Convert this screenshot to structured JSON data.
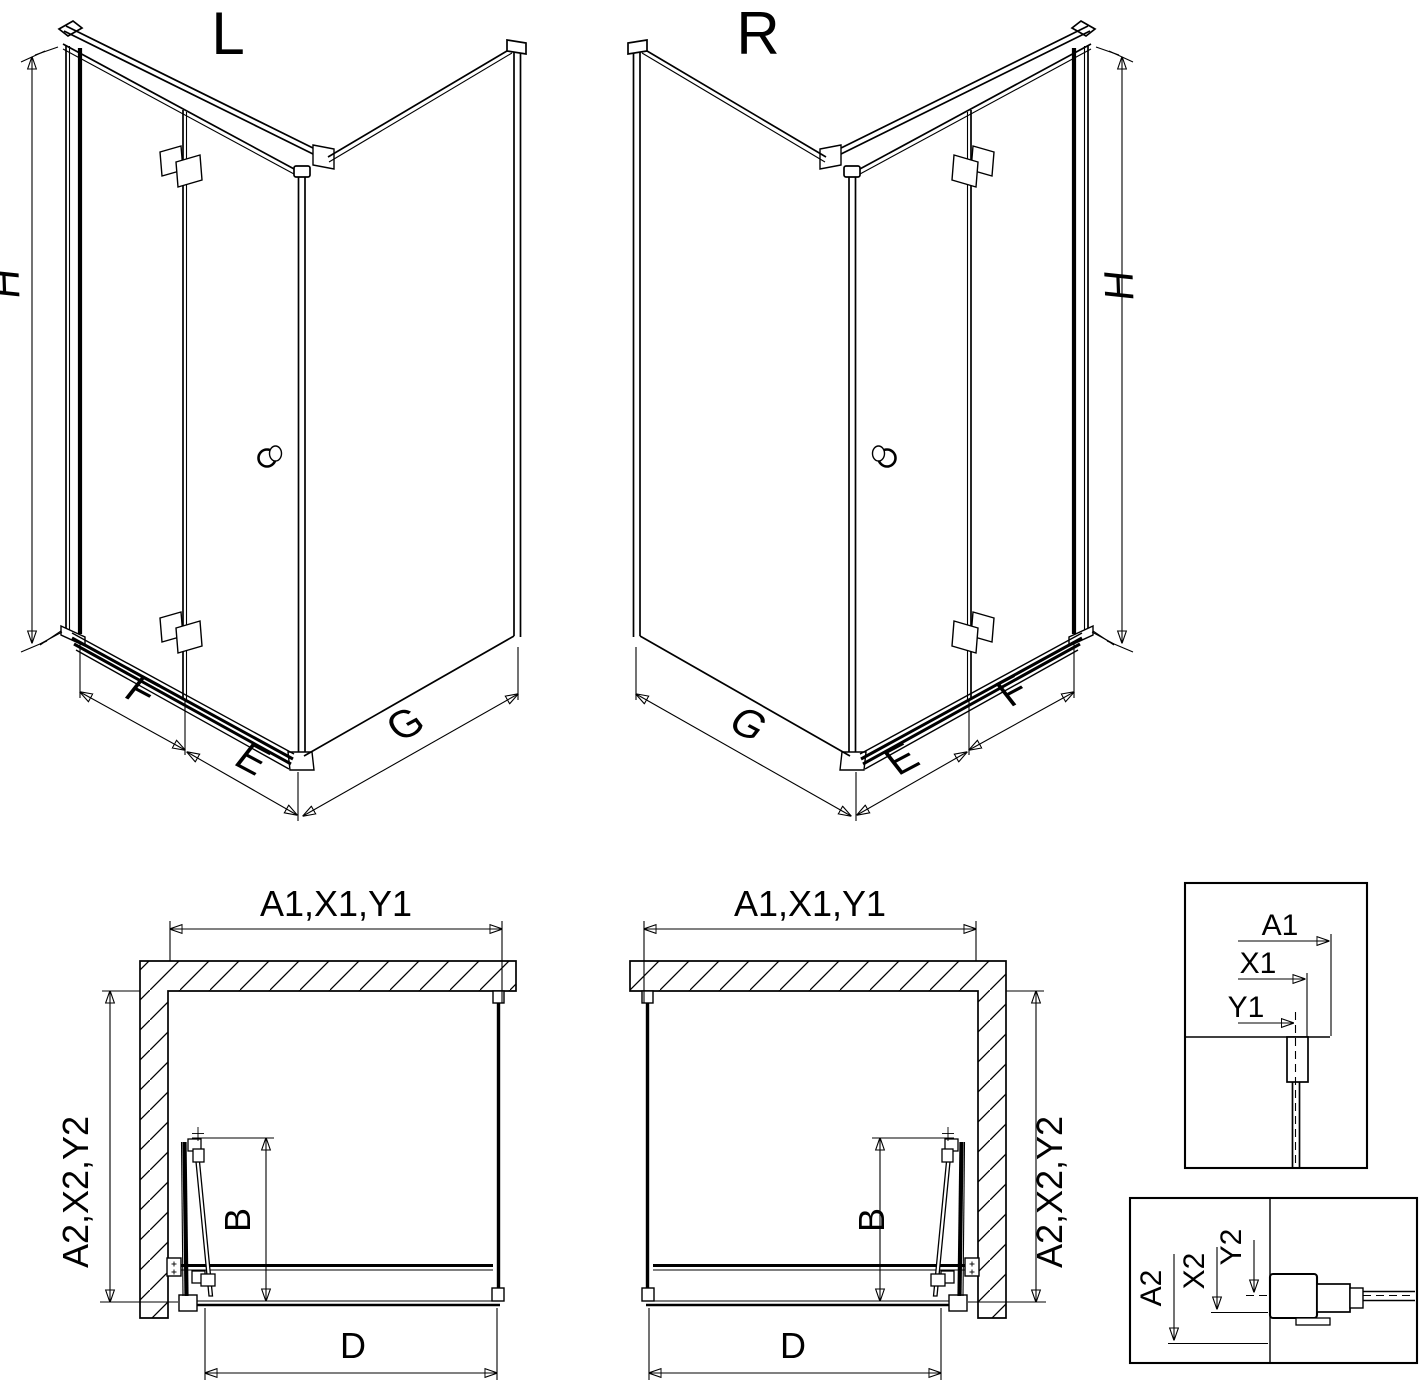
{
  "page": {
    "background": "#ffffff",
    "line_color": "#000000"
  },
  "views_3d": {
    "left": {
      "variant_label": "L",
      "height_label": "H",
      "door_panel_label": "F",
      "door_edge_label": "E",
      "side_panel_label": "G"
    },
    "right": {
      "variant_label": "R",
      "height_label": "H",
      "door_panel_label": "F",
      "door_edge_label": "E",
      "side_panel_label": "G"
    }
  },
  "plans": {
    "left": {
      "width_label": "A1,X1,Y1",
      "depth_label": "A2,X2,Y2",
      "fold_depth_label": "B",
      "opening_label": "D"
    },
    "right": {
      "width_label": "A1,X1,Y1",
      "depth_label": "A2,X2,Y2",
      "fold_depth_label": "B",
      "opening_label": "D"
    }
  },
  "details": {
    "top": {
      "dim1": "A1",
      "dim2": "X1",
      "dim3": "Y1"
    },
    "bottom": {
      "dim1": "A2",
      "dim2": "X2",
      "dim3": "Y2"
    }
  }
}
